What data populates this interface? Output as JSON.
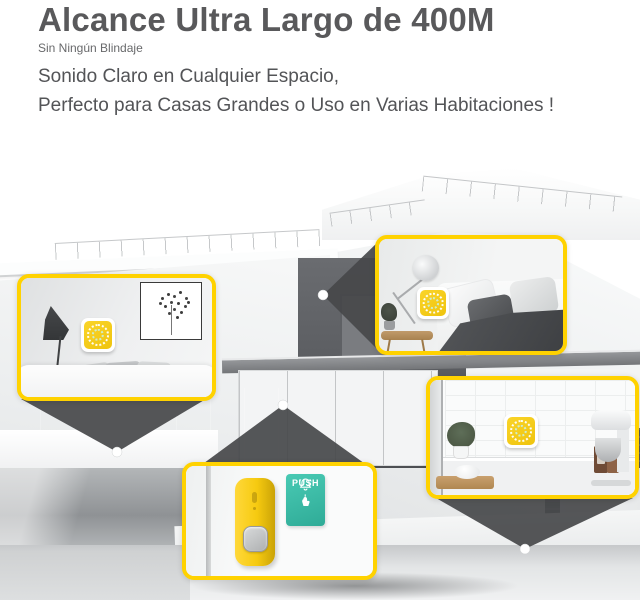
{
  "header": {
    "title": "Alcance Ultra Largo de 400M",
    "subtitle": "Sin Ningún Blindaje",
    "line1": "Sonido Claro en Cualquier Espacio,",
    "line2": "Perfecto para Casas Grandes o Uso en Varias Habitaciones !"
  },
  "push_sign": {
    "label": "PUSH"
  },
  "icons": {
    "bell_icon": "bell",
    "press_hand_icon": "hand-pressing-button",
    "receiver_ring_icon": "dotted-speaker-ring",
    "location_dot_icon": "white-location-dot"
  },
  "colors": {
    "accent_yellow": "#FFD200",
    "device_yellow": "#F6CE1B",
    "push_sign_teal": "#3FBFAB",
    "heading_gray": "#59595B",
    "beam_gray": "#47494B"
  }
}
